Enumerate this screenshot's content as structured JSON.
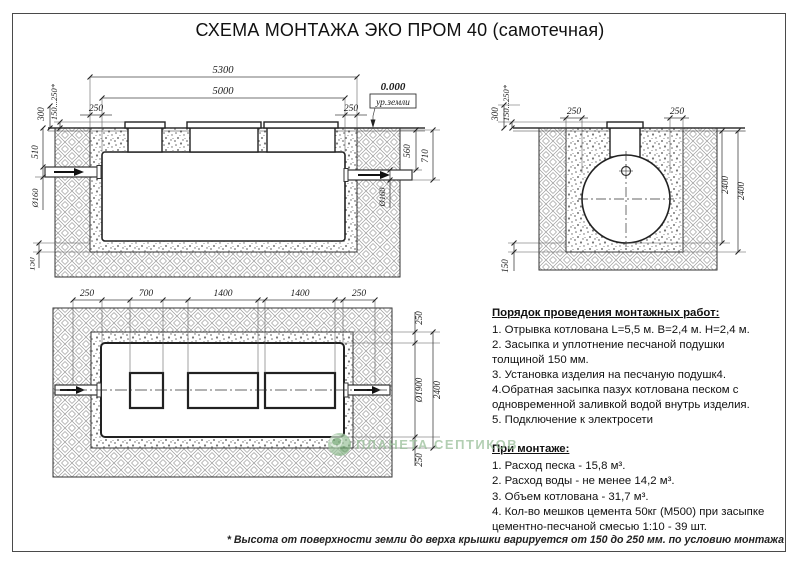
{
  "title": "СХЕМА МОНТАЖА ЭКО ПРОМ 40 (самотечная)",
  "drawings": {
    "side_view": {
      "dims": {
        "overall": "5300",
        "tank": "5000",
        "off_l": "250",
        "off_r": "250",
        "zero": "0.000",
        "ground": "ур.земли",
        "h300": "300",
        "hvar": "150...250*",
        "h510": "510",
        "dia_l": "Ø160",
        "cushion": "150",
        "h560": "560",
        "h710": "710",
        "dia_r": "Ø160"
      }
    },
    "end_view": {
      "dims": {
        "h300": "300",
        "hvar": "150...250*",
        "gap_l": "250",
        "gap_r": "250",
        "depth": "2400",
        "width": "2400",
        "cushion": "150"
      }
    },
    "plan_view": {
      "dims": {
        "off_l": "250",
        "w700": "700",
        "w1400a": "1400",
        "w1400b": "1400",
        "off_r": "250",
        "gap_t": "250",
        "dia": "Ø1900",
        "width": "2400",
        "gap_b": "250"
      }
    }
  },
  "instructions": {
    "heading": "Порядок проведения монтажных работ:",
    "items": [
      "1. Отрывка котлована L=5,5 м. В=2,4 м. Н=2,4 м.",
      "2. Засыпка и уплотнение песчаной подушки толщиной 150 мм.",
      "3. Установка изделия на песчаную подушк4.",
      "4.Обратная засыпка пазух котлована песком с одновременной заливкой водой внутрь изделия.",
      "5. Подключение к электросети"
    ]
  },
  "montage": {
    "heading": "При монтаже:",
    "items": [
      "1. Расход песка - 15,8 м³.",
      "2. Расход воды - не менее 14,2 м³.",
      "3. Объем котлована - 31,7 м³.",
      "4. Кол-во мешков цемента 50кг (М500) при засыпке цементно-песчаной смесью 1:10 - 39 шт."
    ]
  },
  "footnote": "* Высота от поверхности земли до верха крышки варируется от 150 до 250 мм. по условию монтажа",
  "watermark": {
    "text": "ПЛАНЕТА СЕПТИКОВ"
  },
  "colors": {
    "watermark_green": "#96bd96",
    "line": "#2f2f2f",
    "dimension_line": "#444444"
  }
}
